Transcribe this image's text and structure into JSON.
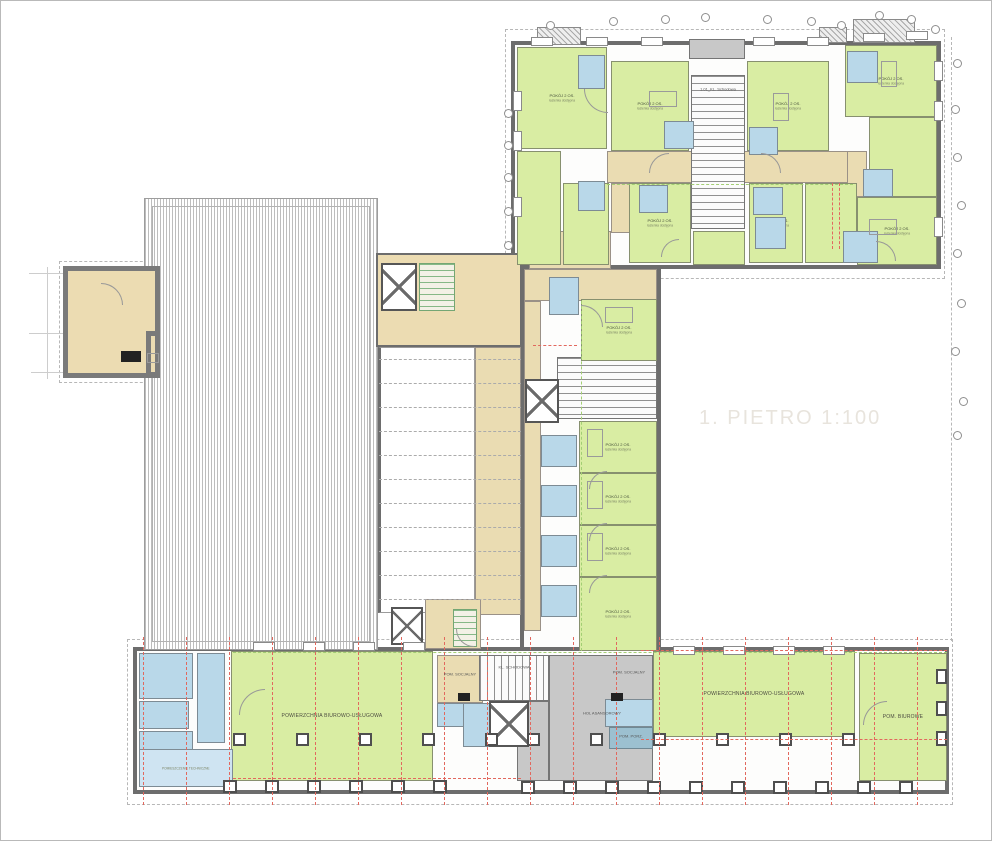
{
  "title": "1. PIETRO  1:100",
  "labels": {
    "pokoj": "POKÓJ 2 OS.",
    "lazienka": "łazienka dostępna",
    "office": "POWIERZCHNIA BIUROWO-USŁUGOWA",
    "biuro": "POM. BIUROWE",
    "tech": "POMIESZCZENIE TECHNICZNE"
  },
  "colors": {
    "room_green": "#d9eda3",
    "bath_blue": "#b9d8e9",
    "corridor_beige": "#eadcb2",
    "stair_gray": "#d2d2d2",
    "wall_dark": "#6d6d6d",
    "red_dash": "#e2685e",
    "green_dash": "#a3cf73",
    "title_gray": "#e8e4dd"
  },
  "text_labels": [
    {
      "x": 717,
      "y": 88,
      "t": "1.01_KL. Schodowa"
    },
    {
      "x": 513,
      "y": 666,
      "t": "KL. SCHODOWA"
    },
    {
      "x": 601,
      "y": 712,
      "t": "HOL ASANSOROWY"
    },
    {
      "x": 459,
      "y": 673,
      "t": "POM. SOCJALNY"
    },
    {
      "x": 628,
      "y": 671,
      "t": "POM. SOCJALNY"
    },
    {
      "x": 630,
      "y": 735,
      "t": "POM. PORZ."
    }
  ],
  "shapes": {
    "dashrects": [
      {
        "x": 504,
        "y": 28,
        "w": 440,
        "h": 250
      },
      {
        "x": 126,
        "y": 638,
        "w": 826,
        "h": 166
      },
      {
        "x": 58,
        "y": 260,
        "w": 104,
        "h": 122
      }
    ],
    "dashv": [
      {
        "x": 950,
        "y": 36,
        "h": 604
      }
    ],
    "guides": [
      {
        "x": 28,
        "y": 272,
        "w": 116,
        "h": 1
      },
      {
        "x": 28,
        "y": 332,
        "w": 116,
        "h": 1
      },
      {
        "x": 30,
        "y": 371,
        "w": 114,
        "h": 1
      },
      {
        "x": 46,
        "y": 266,
        "w": 1,
        "h": 112
      },
      {
        "x": 159,
        "y": 302,
        "w": 219,
        "h": 1
      },
      {
        "x": 159,
        "y": 344,
        "w": 219,
        "h": 1
      }
    ],
    "wings": [
      {
        "x": 510,
        "y": 40,
        "w": 430,
        "h": 228
      },
      {
        "x": 519,
        "y": 268,
        "w": 141,
        "h": 384
      },
      {
        "x": 132,
        "y": 646,
        "w": 816,
        "h": 147
      }
    ],
    "prot45": [
      {
        "x": 536,
        "y": 26,
        "w": 44,
        "h": 18
      },
      {
        "x": 852,
        "y": 18,
        "w": 62,
        "h": 24
      },
      {
        "x": 818,
        "y": 26,
        "w": 28,
        "h": 16
      }
    ],
    "hatch": {
      "x": 143,
      "y": 197,
      "w": 234,
      "h": 452
    },
    "hinner": {
      "x": 151,
      "y": 205,
      "w": 218,
      "h": 436
    },
    "voidw": {
      "x": 377,
      "y": 346,
      "w": 97,
      "h": 266
    },
    "foyer": {
      "x": 375,
      "y": 252,
      "w": 146,
      "h": 94
    },
    "terr": [
      {
        "x": 62,
        "y": 265,
        "w": 97,
        "h": 112
      },
      {
        "x": 145,
        "y": 330,
        "w": 14,
        "h": 46
      }
    ],
    "beige": [
      {
        "x": 606,
        "y": 150,
        "w": 246,
        "h": 32
      },
      {
        "x": 528,
        "y": 230,
        "w": 82,
        "h": 38
      },
      {
        "x": 610,
        "y": 182,
        "w": 24,
        "h": 50
      },
      {
        "x": 846,
        "y": 150,
        "w": 20,
        "h": 46
      },
      {
        "x": 523,
        "y": 268,
        "w": 133,
        "h": 32
      },
      {
        "x": 523,
        "y": 300,
        "w": 17,
        "h": 330
      },
      {
        "x": 474,
        "y": 346,
        "w": 46,
        "h": 268
      },
      {
        "x": 436,
        "y": 654,
        "w": 46,
        "h": 48
      },
      {
        "x": 604,
        "y": 654,
        "w": 48,
        "h": 44
      },
      {
        "x": 424,
        "y": 598,
        "w": 56,
        "h": 50
      }
    ],
    "grays": [
      {
        "x": 688,
        "y": 38,
        "w": 56,
        "h": 20
      },
      {
        "x": 548,
        "y": 654,
        "w": 104,
        "h": 126
      },
      {
        "x": 516,
        "y": 700,
        "w": 32,
        "h": 80
      }
    ],
    "stairs": [
      {
        "x": 690,
        "y": 74,
        "w": 54,
        "h": 154
      },
      {
        "x": 556,
        "y": 356,
        "w": 100,
        "h": 62
      }
    ],
    "stairsv": [
      {
        "x": 478,
        "y": 654,
        "w": 70,
        "h": 46
      }
    ],
    "gstairs": [
      {
        "x": 418,
        "y": 262,
        "w": 36,
        "h": 48
      },
      {
        "x": 452,
        "y": 608,
        "w": 24,
        "h": 38
      }
    ],
    "elevs": [
      {
        "x": 380,
        "y": 262,
        "w": 36,
        "h": 48
      },
      {
        "x": 524,
        "y": 378,
        "w": 34,
        "h": 44
      },
      {
        "x": 488,
        "y": 700,
        "w": 40,
        "h": 46
      },
      {
        "x": 390,
        "y": 606,
        "w": 32,
        "h": 38
      }
    ],
    "rooms": [
      {
        "x": 516,
        "y": 46,
        "w": 90,
        "h": 102,
        "k": "p"
      },
      {
        "x": 610,
        "y": 60,
        "w": 78,
        "h": 90,
        "k": "p"
      },
      {
        "x": 746,
        "y": 60,
        "w": 82,
        "h": 90,
        "k": "p"
      },
      {
        "x": 844,
        "y": 44,
        "w": 92,
        "h": 72,
        "k": "p"
      },
      {
        "x": 868,
        "y": 116,
        "w": 68,
        "h": 80,
        "k": ""
      },
      {
        "x": 516,
        "y": 150,
        "w": 44,
        "h": 114,
        "k": ""
      },
      {
        "x": 562,
        "y": 182,
        "w": 46,
        "h": 82,
        "k": ""
      },
      {
        "x": 628,
        "y": 182,
        "w": 62,
        "h": 80,
        "k": "p"
      },
      {
        "x": 692,
        "y": 230,
        "w": 52,
        "h": 34,
        "k": ""
      },
      {
        "x": 748,
        "y": 182,
        "w": 54,
        "h": 80,
        "k": "p"
      },
      {
        "x": 804,
        "y": 182,
        "w": 52,
        "h": 80,
        "k": ""
      },
      {
        "x": 856,
        "y": 196,
        "w": 80,
        "h": 68,
        "k": "p"
      },
      {
        "x": 580,
        "y": 298,
        "w": 76,
        "h": 62,
        "k": "p"
      },
      {
        "x": 578,
        "y": 420,
        "w": 78,
        "h": 52,
        "k": "p"
      },
      {
        "x": 578,
        "y": 472,
        "w": 78,
        "h": 52,
        "k": "p"
      },
      {
        "x": 578,
        "y": 524,
        "w": 78,
        "h": 52,
        "k": "p"
      },
      {
        "x": 578,
        "y": 576,
        "w": 78,
        "h": 74,
        "k": "p"
      },
      {
        "x": 230,
        "y": 650,
        "w": 202,
        "h": 130,
        "k": "o"
      },
      {
        "x": 652,
        "y": 650,
        "w": 202,
        "h": 86,
        "k": "o"
      },
      {
        "x": 858,
        "y": 652,
        "w": 88,
        "h": 128,
        "k": "b"
      }
    ],
    "baths": [
      {
        "x": 577,
        "y": 54,
        "w": 27,
        "h": 34
      },
      {
        "x": 663,
        "y": 120,
        "w": 30,
        "h": 28
      },
      {
        "x": 748,
        "y": 126,
        "w": 29,
        "h": 28
      },
      {
        "x": 577,
        "y": 180,
        "w": 27,
        "h": 30
      },
      {
        "x": 638,
        "y": 184,
        "w": 29,
        "h": 28
      },
      {
        "x": 752,
        "y": 186,
        "w": 30,
        "h": 28
      },
      {
        "x": 754,
        "y": 216,
        "w": 31,
        "h": 32
      },
      {
        "x": 846,
        "y": 50,
        "w": 31,
        "h": 32
      },
      {
        "x": 862,
        "y": 168,
        "w": 30,
        "h": 28
      },
      {
        "x": 842,
        "y": 230,
        "w": 35,
        "h": 32
      },
      {
        "x": 548,
        "y": 276,
        "w": 30,
        "h": 38
      },
      {
        "x": 540,
        "y": 434,
        "w": 36,
        "h": 32
      },
      {
        "x": 540,
        "y": 484,
        "w": 36,
        "h": 32
      },
      {
        "x": 540,
        "y": 534,
        "w": 36,
        "h": 32
      },
      {
        "x": 540,
        "y": 584,
        "w": 36,
        "h": 32
      },
      {
        "x": 138,
        "y": 652,
        "w": 54,
        "h": 46
      },
      {
        "x": 196,
        "y": 652,
        "w": 28,
        "h": 90
      },
      {
        "x": 138,
        "y": 700,
        "w": 50,
        "h": 28
      },
      {
        "x": 138,
        "y": 730,
        "w": 54,
        "h": 24
      },
      {
        "x": 436,
        "y": 702,
        "w": 30,
        "h": 24
      },
      {
        "x": 462,
        "y": 702,
        "w": 28,
        "h": 44
      },
      {
        "x": 604,
        "y": 698,
        "w": 48,
        "h": 28
      }
    ],
    "tech": {
      "x": 138,
      "y": 748,
      "w": 94,
      "h": 38
    },
    "teal": {
      "x": 608,
      "y": 726,
      "w": 44,
      "h": 22
    },
    "voiddash": [
      358,
      382,
      406,
      430,
      454,
      478,
      502,
      526,
      550,
      574,
      598
    ],
    "grnh": [
      {
        "x": 606,
        "y": 183,
        "w": 246
      },
      {
        "x": 232,
        "y": 651,
        "w": 714
      }
    ],
    "grnv": [
      {
        "x": 580,
        "y": 300,
        "h": 350
      }
    ],
    "windows": [
      {
        "x": 530,
        "y": 36,
        "w": 22,
        "h": 9
      },
      {
        "x": 585,
        "y": 36,
        "w": 22,
        "h": 9
      },
      {
        "x": 640,
        "y": 36,
        "w": 22,
        "h": 9
      },
      {
        "x": 752,
        "y": 36,
        "w": 22,
        "h": 9
      },
      {
        "x": 806,
        "y": 36,
        "w": 22,
        "h": 9
      },
      {
        "x": 862,
        "y": 32,
        "w": 22,
        "h": 9
      },
      {
        "x": 905,
        "y": 30,
        "w": 22,
        "h": 9
      },
      {
        "x": 252,
        "y": 641,
        "w": 22,
        "h": 9
      },
      {
        "x": 302,
        "y": 641,
        "w": 22,
        "h": 9
      },
      {
        "x": 352,
        "y": 641,
        "w": 22,
        "h": 9
      },
      {
        "x": 402,
        "y": 641,
        "w": 22,
        "h": 9
      },
      {
        "x": 672,
        "y": 645,
        "w": 22,
        "h": 9
      },
      {
        "x": 722,
        "y": 645,
        "w": 22,
        "h": 9
      },
      {
        "x": 772,
        "y": 645,
        "w": 22,
        "h": 9
      },
      {
        "x": 822,
        "y": 645,
        "w": 22,
        "h": 9
      },
      {
        "x": 512,
        "y": 90,
        "w": 9,
        "h": 20
      },
      {
        "x": 512,
        "y": 130,
        "w": 9,
        "h": 20
      },
      {
        "x": 512,
        "y": 196,
        "w": 9,
        "h": 20
      },
      {
        "x": 933,
        "y": 60,
        "w": 9,
        "h": 20
      },
      {
        "x": 933,
        "y": 100,
        "w": 9,
        "h": 20
      },
      {
        "x": 933,
        "y": 216,
        "w": 9,
        "h": 20
      }
    ],
    "cols": [
      {
        "x": 222,
        "y": 779,
        "w": 14,
        "h": 13
      },
      {
        "x": 264,
        "y": 779,
        "w": 14,
        "h": 13
      },
      {
        "x": 306,
        "y": 779,
        "w": 14,
        "h": 13
      },
      {
        "x": 348,
        "y": 779,
        "w": 14,
        "h": 13
      },
      {
        "x": 390,
        "y": 779,
        "w": 14,
        "h": 13
      },
      {
        "x": 432,
        "y": 779,
        "w": 14,
        "h": 13
      },
      {
        "x": 232,
        "y": 732,
        "w": 13,
        "h": 13
      },
      {
        "x": 295,
        "y": 732,
        "w": 13,
        "h": 13
      },
      {
        "x": 358,
        "y": 732,
        "w": 13,
        "h": 13
      },
      {
        "x": 421,
        "y": 732,
        "w": 13,
        "h": 13
      },
      {
        "x": 484,
        "y": 732,
        "w": 13,
        "h": 13
      },
      {
        "x": 526,
        "y": 732,
        "w": 13,
        "h": 13
      },
      {
        "x": 589,
        "y": 732,
        "w": 13,
        "h": 13
      },
      {
        "x": 652,
        "y": 732,
        "w": 13,
        "h": 13
      },
      {
        "x": 715,
        "y": 732,
        "w": 13,
        "h": 13
      },
      {
        "x": 778,
        "y": 732,
        "w": 13,
        "h": 13
      },
      {
        "x": 841,
        "y": 732,
        "w": 13,
        "h": 13
      },
      {
        "x": 935,
        "y": 668,
        "w": 11,
        "h": 15
      },
      {
        "x": 935,
        "y": 700,
        "w": 11,
        "h": 15
      },
      {
        "x": 935,
        "y": 730,
        "w": 11,
        "h": 15
      },
      {
        "x": 520,
        "y": 780,
        "w": 14,
        "h": 13
      },
      {
        "x": 562,
        "y": 780,
        "w": 14,
        "h": 13
      },
      {
        "x": 604,
        "y": 780,
        "w": 14,
        "h": 13
      },
      {
        "x": 646,
        "y": 780,
        "w": 14,
        "h": 13
      },
      {
        "x": 688,
        "y": 780,
        "w": 14,
        "h": 13
      },
      {
        "x": 730,
        "y": 780,
        "w": 14,
        "h": 13
      },
      {
        "x": 772,
        "y": 780,
        "w": 14,
        "h": 13
      },
      {
        "x": 814,
        "y": 780,
        "w": 14,
        "h": 13
      },
      {
        "x": 856,
        "y": 780,
        "w": 14,
        "h": 13
      },
      {
        "x": 898,
        "y": 780,
        "w": 14,
        "h": 13
      }
    ],
    "redv": [
      {
        "x": 142
      },
      {
        "x": 185
      },
      {
        "x": 228
      },
      {
        "x": 271
      },
      {
        "x": 314
      },
      {
        "x": 357
      },
      {
        "x": 400
      },
      {
        "x": 443
      },
      {
        "x": 486
      },
      {
        "x": 529
      },
      {
        "x": 572
      },
      {
        "x": 615
      },
      {
        "x": 658
      },
      {
        "x": 701
      },
      {
        "x": 744
      },
      {
        "x": 787
      },
      {
        "x": 830
      },
      {
        "x": 873
      },
      {
        "x": 916
      },
      {
        "x": 831,
        "y": 182,
        "h": 66
      },
      {
        "x": 838,
        "y": 182,
        "h": 66
      }
    ],
    "redh": [
      {
        "x": 640,
        "y": 649,
        "w": 306
      },
      {
        "x": 640,
        "y": 738,
        "w": 306
      },
      {
        "x": 232,
        "y": 777,
        "w": 288
      },
      {
        "x": 532,
        "y": 344,
        "w": 44
      }
    ],
    "circles": [
      {
        "x": 545,
        "y": 20
      },
      {
        "x": 608,
        "y": 16
      },
      {
        "x": 660,
        "y": 14
      },
      {
        "x": 700,
        "y": 12
      },
      {
        "x": 762,
        "y": 14
      },
      {
        "x": 806,
        "y": 16
      },
      {
        "x": 836,
        "y": 20
      },
      {
        "x": 874,
        "y": 10
      },
      {
        "x": 906,
        "y": 14
      },
      {
        "x": 930,
        "y": 24
      },
      {
        "x": 952,
        "y": 58
      },
      {
        "x": 950,
        "y": 104
      },
      {
        "x": 952,
        "y": 152
      },
      {
        "x": 956,
        "y": 200
      },
      {
        "x": 952,
        "y": 248
      },
      {
        "x": 956,
        "y": 298
      },
      {
        "x": 950,
        "y": 346
      },
      {
        "x": 958,
        "y": 396
      },
      {
        "x": 952,
        "y": 430
      },
      {
        "x": 503,
        "y": 108
      },
      {
        "x": 503,
        "y": 140
      },
      {
        "x": 503,
        "y": 172
      },
      {
        "x": 503,
        "y": 206
      },
      {
        "x": 503,
        "y": 240
      }
    ],
    "arcs": [
      {
        "x": 583,
        "y": 88,
        "r": 24,
        "q": "bl"
      },
      {
        "x": 648,
        "y": 152,
        "r": 20,
        "q": "tl"
      },
      {
        "x": 760,
        "y": 152,
        "r": 20,
        "q": "tr"
      },
      {
        "x": 580,
        "y": 304,
        "r": 22,
        "q": "tr"
      },
      {
        "x": 588,
        "y": 470,
        "r": 18,
        "q": "tl"
      },
      {
        "x": 588,
        "y": 522,
        "r": 18,
        "q": "tl"
      },
      {
        "x": 588,
        "y": 574,
        "r": 18,
        "q": "tl"
      },
      {
        "x": 238,
        "y": 688,
        "r": 26,
        "q": "tl"
      },
      {
        "x": 862,
        "y": 700,
        "r": 24,
        "q": "tl"
      },
      {
        "x": 455,
        "y": 628,
        "r": 18,
        "q": "bl"
      },
      {
        "x": 875,
        "y": 240,
        "r": 20,
        "q": "tr"
      },
      {
        "x": 660,
        "y": 238,
        "r": 18,
        "q": "tl"
      },
      {
        "x": 100,
        "y": 282,
        "r": 22,
        "q": "tr"
      }
    ],
    "furn": [
      {
        "x": 586,
        "y": 428,
        "w": 16,
        "h": 28
      },
      {
        "x": 586,
        "y": 480,
        "w": 16,
        "h": 28
      },
      {
        "x": 586,
        "y": 532,
        "w": 16,
        "h": 28
      },
      {
        "x": 604,
        "y": 306,
        "w": 28,
        "h": 16
      },
      {
        "x": 648,
        "y": 90,
        "w": 28,
        "h": 16
      },
      {
        "x": 772,
        "y": 92,
        "w": 16,
        "h": 28
      },
      {
        "x": 868,
        "y": 218,
        "w": 28,
        "h": 16
      },
      {
        "x": 146,
        "y": 352,
        "w": 12,
        "h": 10
      },
      {
        "x": 880,
        "y": 60,
        "w": 16,
        "h": 26
      }
    ],
    "black": [
      {
        "x": 457,
        "y": 692,
        "w": 12,
        "h": 8
      },
      {
        "x": 610,
        "y": 692,
        "w": 12,
        "h": 8
      },
      {
        "x": 120,
        "y": 350,
        "w": 20,
        "h": 11
      }
    ]
  }
}
